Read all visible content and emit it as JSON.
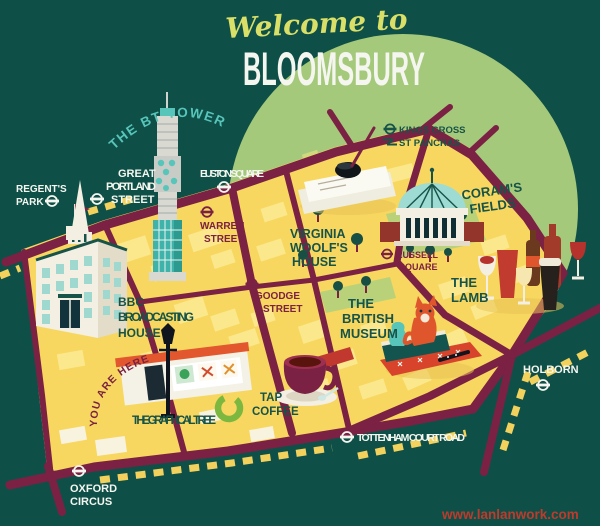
{
  "title": {
    "welcome": "Welcome to",
    "name": "BLOOMSBURY"
  },
  "watermark": "www.lanlanwork.com",
  "stations": {
    "regents_park": {
      "l1": "REGENT'S",
      "l2": "PARK"
    },
    "great_portland": {
      "l1": "GREAT",
      "l2": "PORTLAND",
      "l3": "STREET"
    },
    "euston_square": {
      "l1": "EUSTON SQUARE"
    },
    "kings_cross": {
      "l1": "KINGS CROSS",
      "l2": "ST PANCRAS"
    },
    "warren_street": {
      "l1": "WARREN",
      "l2": "STREET"
    },
    "goodge_street": {
      "l1": "GOODGE",
      "l2": "STREET"
    },
    "russell_square": {
      "l1": "RUSSELL",
      "l2": "SQUARE"
    },
    "oxford_circus": {
      "l1": "OXFORD",
      "l2": "CIRCUS"
    },
    "tottenham": {
      "l1": "TOTTENHAM COURT ROAD"
    },
    "holborn": {
      "l1": "HOLBORN"
    }
  },
  "landmarks": {
    "bt_tower": {
      "label": "THE BT TOWER"
    },
    "bbc": {
      "l1": "BBC",
      "l2": "BROADCASTING",
      "l3": "HOUSE"
    },
    "virginia_woolf": {
      "l1": "VIRGINIA",
      "l2": "WOOLF'S",
      "l3": "HOUSE"
    },
    "corams_fields": {
      "l1": "CORAM'S",
      "l2": "FIELDS"
    },
    "british_museum": {
      "l1": "THE",
      "l2": "BRITISH",
      "l3": "MUSEUM"
    },
    "the_lamb": {
      "l1": "THE",
      "l2": "LAMB"
    },
    "graphical_tree": {
      "label": "THE GRAPHICAL TREE"
    },
    "tap_coffee": {
      "l1": "TAP",
      "l2": "COFFEE"
    },
    "you_are_here": {
      "label": "YOU ARE HERE"
    }
  },
  "colors": {
    "background": "#0e5048",
    "circle": "#a5c97b",
    "map_yellow": "#f7d75f",
    "block_yellow": "#fbe88d",
    "road_maroon": "#7b2143",
    "teal_dark": "#175348",
    "teal_light": "#58c5ba",
    "lawn_green": "#b9d27a",
    "white": "#f5f6ef",
    "script_green": "#d9df67",
    "watermark_red": "#c0392b"
  }
}
